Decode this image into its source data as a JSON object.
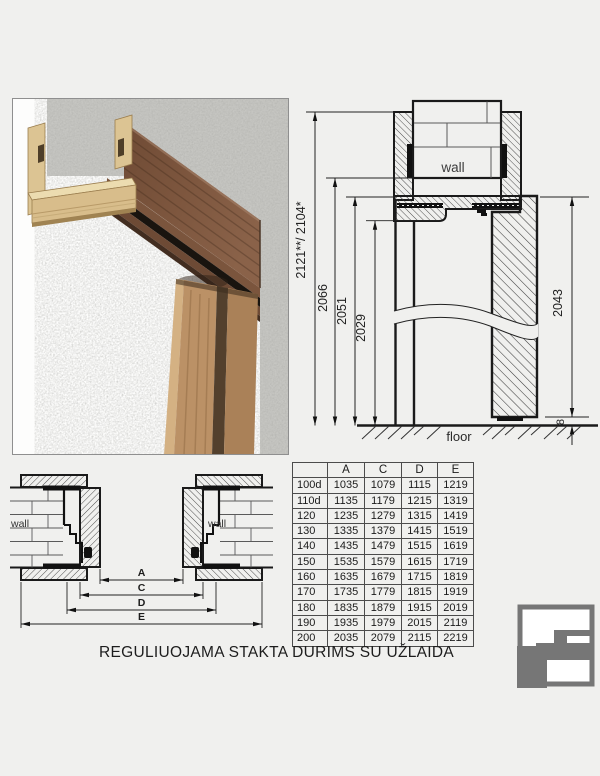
{
  "vertical_section": {
    "wall_label": "wall",
    "floor_label": "floor",
    "dim_total": "2121**/ 2104*",
    "dim_wall": "2066",
    "dim_frame": "2051",
    "dim_opening": "2029",
    "dim_leaf": "2043",
    "dim_gap": "8"
  },
  "horizontal_section": {
    "wall_label_left": "wall",
    "wall_label_right": "wall",
    "dim_a": "A",
    "dim_c": "C",
    "dim_d": "D",
    "dim_e": "E"
  },
  "size_table": {
    "headers": [
      "",
      "A",
      "C",
      "D",
      "E"
    ],
    "rows": [
      [
        "100d",
        "1035",
        "1079",
        "1115",
        "1219"
      ],
      [
        "110d",
        "1135",
        "1179",
        "1215",
        "1319"
      ],
      [
        "120",
        "1235",
        "1279",
        "1315",
        "1419"
      ],
      [
        "130",
        "1335",
        "1379",
        "1415",
        "1519"
      ],
      [
        "140",
        "1435",
        "1479",
        "1515",
        "1619"
      ],
      [
        "150",
        "1535",
        "1579",
        "1615",
        "1719"
      ],
      [
        "160",
        "1635",
        "1679",
        "1715",
        "1819"
      ],
      [
        "170",
        "1735",
        "1779",
        "1815",
        "1919"
      ],
      [
        "180",
        "1835",
        "1879",
        "1915",
        "2019"
      ],
      [
        "190",
        "1935",
        "1979",
        "2015",
        "2119"
      ],
      [
        "200",
        "2035",
        "2079",
        "2115",
        "2219"
      ]
    ]
  },
  "caption": "REGULIUOJAMA STAKTA DURIMS SU UŽLAIDA",
  "colors": {
    "background": "#f0f0ee",
    "line": "#1a1a1a",
    "logo_gray": "#767676",
    "concrete": "#c6c6c2",
    "mdf_wood": "#dcc493",
    "walnut_dark": "#6f4b35",
    "walnut_light": "#8a6249",
    "oak": "#bb9166",
    "seal_black": "#19140f"
  }
}
